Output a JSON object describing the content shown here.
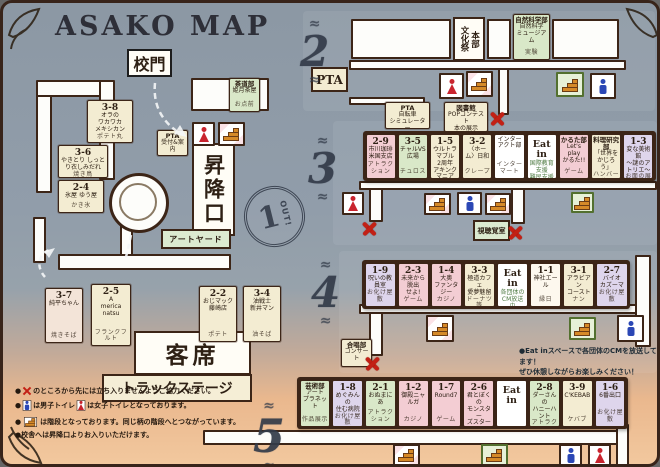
{
  "title": "ASAKO MAP",
  "labels": {
    "school_gate": "校門",
    "entrance": "昇降口",
    "seating": "客席",
    "truck_stage": "トラックステージ",
    "art_yard": "アートヤード",
    "av_room": "視聴覚室",
    "pta": "PTA",
    "culture_fest": "文化祭",
    "hq": "本部",
    "eat_in": "Eat in",
    "out": "OUT!",
    "floor1": "1",
    "floor2": "2",
    "floor3": "3",
    "floor4": "4",
    "floor5": "5"
  },
  "stalls": {
    "floor1_scattered": [
      {
        "id": "s38",
        "num": "3-8",
        "lines": [
          "オラの",
          "ワカワカ",
          "メキシカン"
        ],
        "food": "ポテト丸",
        "bg": "#f3ecd2"
      },
      {
        "id": "s36",
        "num": "3-6",
        "lines": [
          "やきとり しっとり衣しみだれ"
        ],
        "food": "焼き鳥",
        "bg": "#f3ecd2"
      },
      {
        "id": "s24",
        "num": "2-4",
        "lines": [
          "氷屋 ゆう屋"
        ],
        "food": "かき氷",
        "bg": "#f3ecd2"
      },
      {
        "id": "s37",
        "num": "3-7",
        "lines": [
          "純平ちゃん"
        ],
        "food": "焼きそば",
        "bg": "#f3e4d8"
      },
      {
        "id": "s25",
        "num": "2-5",
        "lines": [
          "A",
          "merica",
          "natsu"
        ],
        "food": "フランクフルト",
        "bg": "#f3ecd2"
      },
      {
        "id": "s22",
        "num": "2-2",
        "lines": [
          "おじマック",
          "藤崎店"
        ],
        "food": "ポテト",
        "bg": "#f3ecd2"
      },
      {
        "id": "s34",
        "num": "3-4",
        "lines": [
          "油戦士",
          "新井マン"
        ],
        "food": "油そば",
        "bg": "#f3ecd2"
      },
      {
        "id": "sado",
        "name": "tea-ceremony-club",
        "title": "茶道部",
        "lines": [
          "姫月茶屋"
        ],
        "food": "お点前",
        "bg": "#d9e8c8"
      },
      {
        "id": "pta1",
        "name": "pta-reception",
        "title": "PTA",
        "lines": [
          "受付&案内"
        ],
        "bg": "#f3ecd2"
      }
    ],
    "floor2_misc": [
      {
        "id": "ptasim",
        "name": "pta-bike-simulator",
        "title": "PTA",
        "lines": [
          "自転車",
          "シミュレーター"
        ],
        "bg": "#f3ecd2"
      },
      {
        "id": "tosho",
        "name": "library",
        "title": "図書館",
        "lines": [
          "POPコンテスト",
          "本の展示"
        ],
        "bg": "#f3ecd2"
      },
      {
        "id": "shizen",
        "name": "science-club",
        "title": "自然科学部",
        "lines": [
          "自然科学",
          "ミュージアム"
        ],
        "food": "実験",
        "bg": "#d9e8c8"
      }
    ],
    "floor3_row": [
      {
        "num": "2-9",
        "lines": [
          "市川珈琲",
          "米国支店"
        ],
        "food": "アトラクション",
        "bg": "#f3cdd3"
      },
      {
        "num": "3-5",
        "lines": [
          "チャルVS広場"
        ],
        "food": "チュロス",
        "bg": "#d9e8c8"
      },
      {
        "num": "1-5",
        "lines": [
          "ウルトラマブル",
          "2周年",
          "アキンクマニア"
        ],
        "food": "アトラクション",
        "bg": "#f3ecd2"
      },
      {
        "num": "3-2",
        "lines": [
          "〈ホーム〉日和"
        ],
        "food": "クレープ",
        "bg": "#f3ecd2"
      },
      {
        "name": "interact-club",
        "lines": [
          "インター",
          "アクト部"
        ],
        "food": "インターマート",
        "bg": "#ffffff"
      },
      {
        "name": "eat-in",
        "eatin": true,
        "lines": [
          "国際教育支援",
          "難民支援"
        ],
        "bg": "#ffffff"
      },
      {
        "name": "karuta-club",
        "title": "かるた部",
        "lines": [
          "Let's play",
          "かるた!!"
        ],
        "food": "ゲーム",
        "bg": "#f3cdd3"
      },
      {
        "name": "cooking-club",
        "title": "料理研究部",
        "lines": [
          "「世界を",
          "かじろう」"
        ],
        "food": "ハンバーガー",
        "bg": "#f3ecd2"
      },
      {
        "num": "1-3",
        "lines": [
          "変な美術館",
          "〜謎のアトリエ〜"
        ],
        "food": "お面の展示",
        "bg": "#ded5ec"
      }
    ],
    "floor4_row": [
      {
        "num": "1-9",
        "lines": [
          "呪いの教員室"
        ],
        "food": "お化け屋敷",
        "bg": "#ded5ec"
      },
      {
        "num": "2-3",
        "lines": [
          "未来から脱出",
          "せよ!"
        ],
        "food": "ゲーム",
        "bg": "#f3cdd3"
      },
      {
        "num": "1-4",
        "lines": [
          "大奥",
          "ファンタジー"
        ],
        "food": "カジノ",
        "bg": "#f3cdd3"
      },
      {
        "num": "3-3",
        "lines": [
          "極道カフェ",
          "愛夢魅留"
        ],
        "food": "ドーナツ等",
        "bg": "#f3ecd2"
      },
      {
        "name": "eat-in",
        "eatin": true,
        "lines": [
          "各団体の",
          "CM放送中"
        ],
        "bg": "#ffffff"
      },
      {
        "num": "1-1",
        "lines": [
          "神社エール"
        ],
        "food": "縁日",
        "bg": "#fdf8ee"
      },
      {
        "num": "3-1",
        "lines": [
          "アラビアン",
          "コースト"
        ],
        "food": "ナン",
        "bg": "#f3ecd2"
      },
      {
        "num": "2-7",
        "lines": [
          "バイオ",
          "カズーマ"
        ],
        "food": "お化け屋敷",
        "bg": "#ded5ec"
      }
    ],
    "floor4_misc": [
      {
        "id": "gassho",
        "name": "chorus-club",
        "title": "合唱部",
        "lines": [
          "コンサート"
        ],
        "bg": "#f3ecd2"
      }
    ],
    "floor5_row": [
      {
        "name": "art-club",
        "title": "芸術部",
        "lines": [
          "アート",
          "プラネット"
        ],
        "food": "作品展示",
        "bg": "#d9e8c8"
      },
      {
        "num": "1-8",
        "lines": [
          "めぐみんの",
          "住む病院"
        ],
        "food": "お化け屋敷",
        "bg": "#ded5ec"
      },
      {
        "num": "2-1",
        "lines": [
          "おぬまにあ"
        ],
        "food": "アトラクション",
        "bg": "#d9e8c8"
      },
      {
        "num": "1-2",
        "lines": [
          "御殿ニャルガ"
        ],
        "food": "カジノ",
        "bg": "#f3cdd3"
      },
      {
        "num": "1-7",
        "lines": [
          "Round7"
        ],
        "food": "ゲーム",
        "bg": "#f3cdd3"
      },
      {
        "num": "2-6",
        "lines": [
          "君とぼくの",
          "モンスター",
          "ズスター屋"
        ],
        "food": "アトラクション",
        "bg": "#f3cdd3"
      },
      {
        "name": "eat-in",
        "eatin": true,
        "lines": [],
        "bg": "#ffffff"
      },
      {
        "num": "2-8",
        "lines": [
          "ダーさんの",
          "ハニーハント"
        ],
        "food": "アトラクション",
        "bg": "#d9e8c8"
      },
      {
        "num": "3-9",
        "lines": [
          "C'KEBAB"
        ],
        "food": "ケバブ",
        "bg": "#f3ecd2"
      },
      {
        "num": "1-6",
        "lines": [
          "6番出口"
        ],
        "food": "お化け屋敷",
        "bg": "#ded5ec"
      }
    ]
  },
  "note_floor4": [
    "●Eat inスペースで各団体のCMを放送してます！",
    "ぜひ休憩しながらお楽しみください！"
  ],
  "legend": {
    "line1": "のところから先には立ち入りませんようご協力ください。",
    "line2a": "は男子トイレ",
    "line2b": "は女子トイレとなっております。",
    "line3": "は階段となっております。同じ柄の階段へとつながっています。",
    "line4": "●校舎へは昇降口よりお入りいただけます。"
  },
  "colors": {
    "border": "#3c2517",
    "cream": "#f3ecd2",
    "pink": "#f3cdd3",
    "lavender": "#ded5ec",
    "green": "#d9e8c8",
    "male": "#2b47b5",
    "female": "#c9242e",
    "stairs": "#d68a28",
    "xmark": "#c32015",
    "sunset": "#eab88e",
    "slate": "#8c98a4"
  }
}
